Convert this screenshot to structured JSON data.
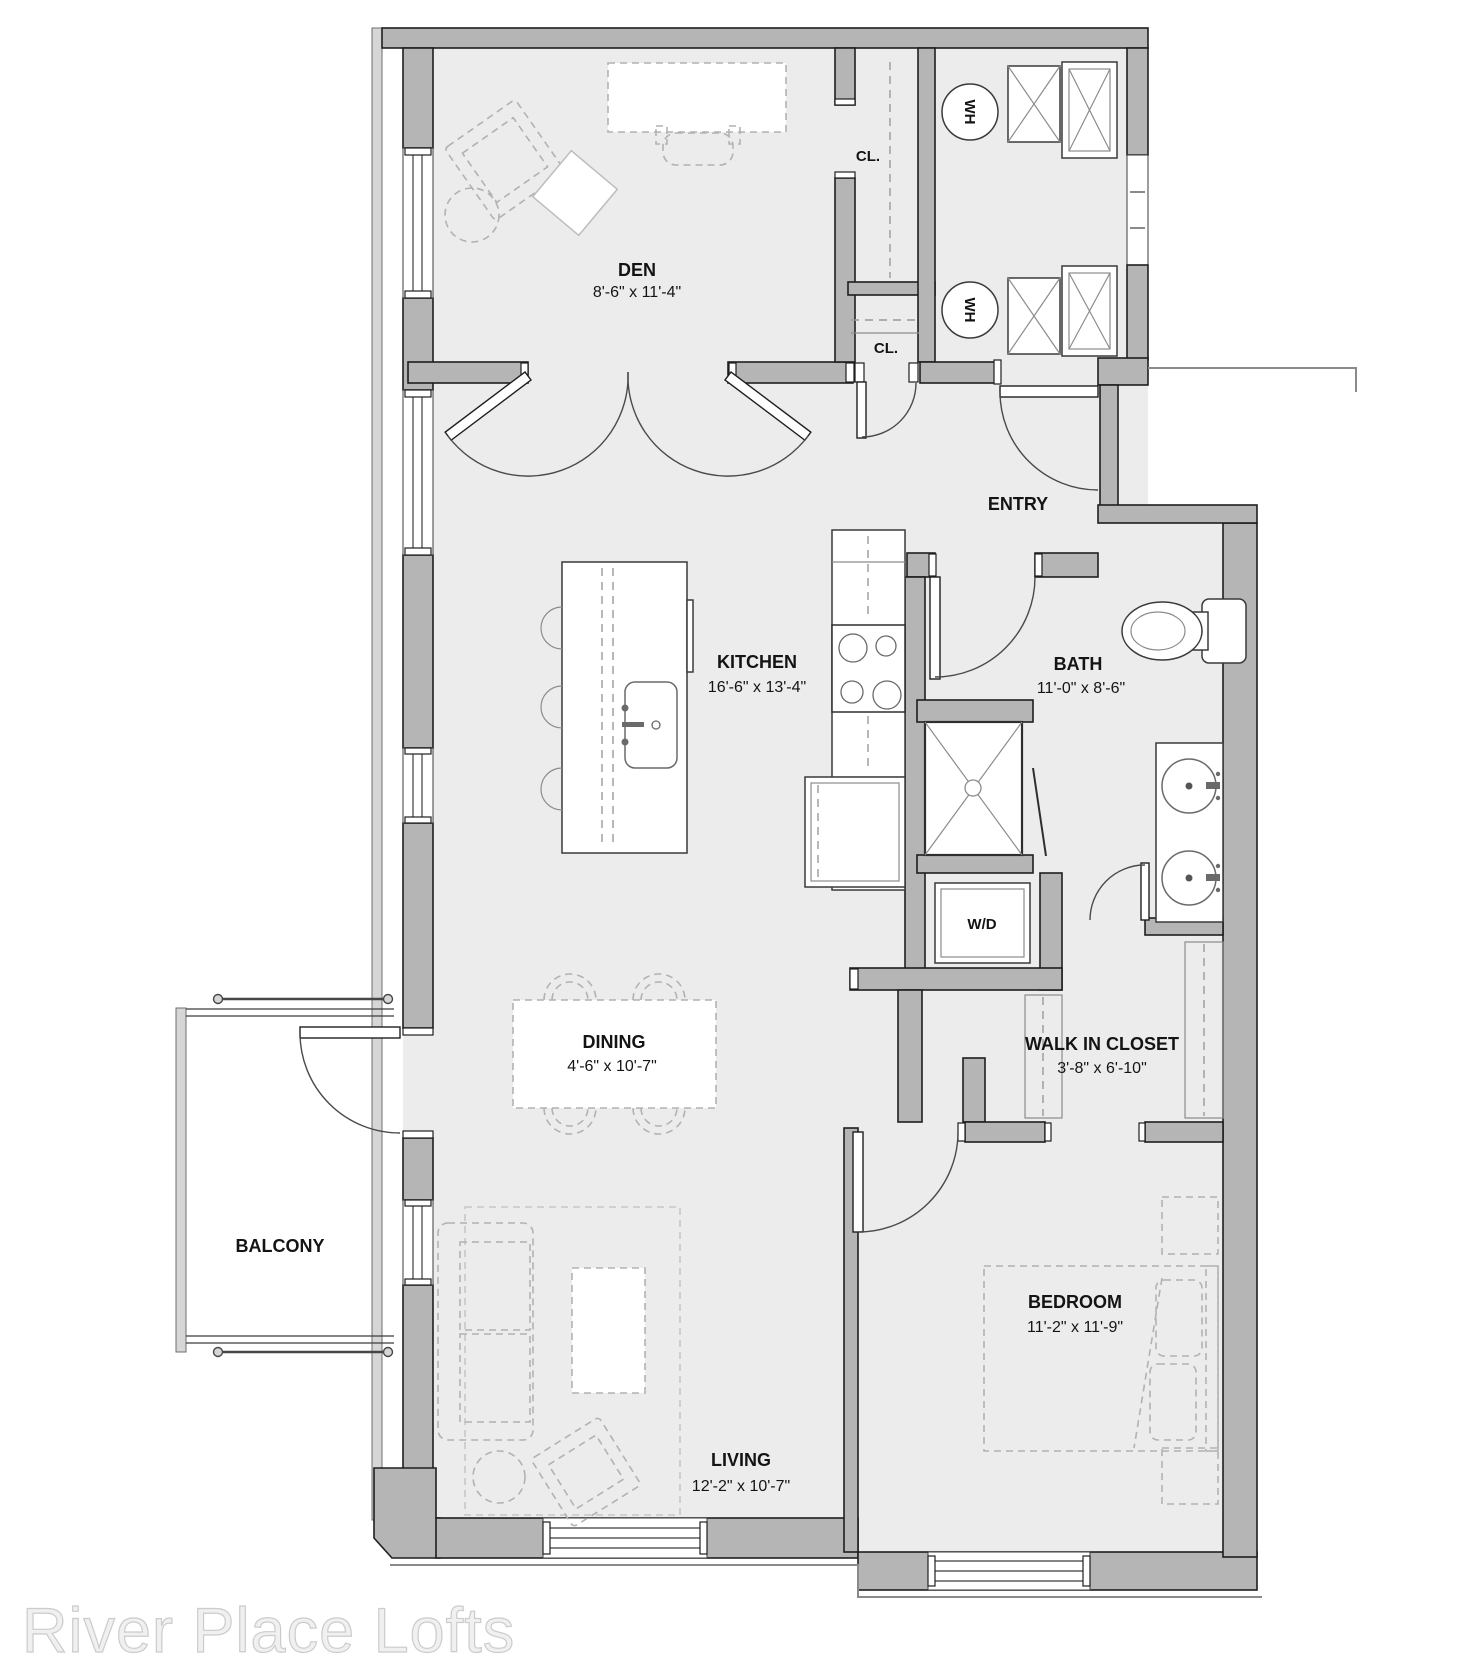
{
  "watermark": {
    "text": "River Place Lofts"
  },
  "rooms": {
    "den": {
      "name": "DEN",
      "dims": "8'-6\" x 11'-4\""
    },
    "kitchen": {
      "name": "KITCHEN",
      "dims": "16'-6\" x 13'-4\""
    },
    "bath": {
      "name": "BATH",
      "dims": "11'-0\" x 8'-6\""
    },
    "entry": {
      "name": "ENTRY"
    },
    "dining": {
      "name": "DINING",
      "dims": "4'-6\" x 10'-7\""
    },
    "walk_in_closet": {
      "name": "WALK IN CLOSET",
      "dims": "3'-8\" x 6'-10\""
    },
    "balcony": {
      "name": "BALCONY"
    },
    "living": {
      "name": "LIVING",
      "dims": "12'-2\" x 10'-7\""
    },
    "bedroom": {
      "name": "BEDROOM",
      "dims": "11'-2\" x 11'-9\""
    },
    "closet_upper": {
      "label": "CL."
    },
    "closet_lower": {
      "label": "CL."
    }
  },
  "fixtures": {
    "water_heater": "WH",
    "washer_dryer": "W/D"
  },
  "colors": {
    "wall": "#b5b5b5",
    "floor": "#ececec",
    "line": "#1f1f1f",
    "furniture_dash": "#b2b2b2",
    "watermark": "#f0f0f0"
  }
}
